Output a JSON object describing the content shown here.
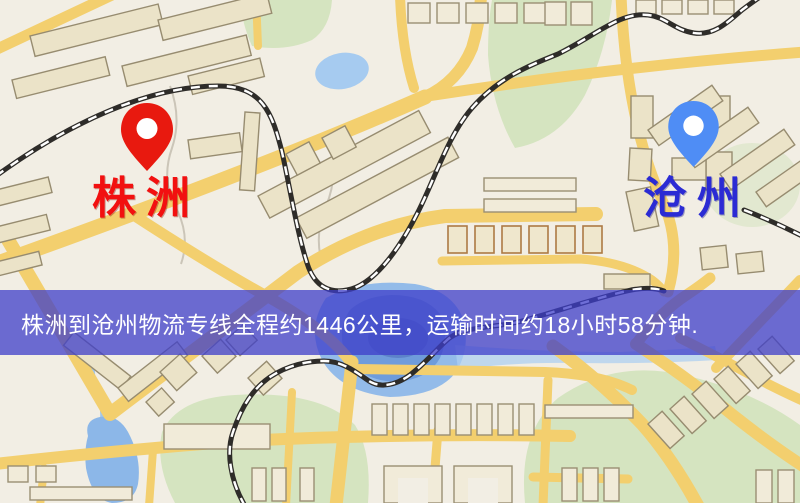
{
  "map": {
    "origin": {
      "name": "株洲",
      "pin_color": "#e8190f",
      "label_color": "#f21010"
    },
    "destination": {
      "name": "沧州",
      "pin_color": "#4f8df5",
      "label_color": "#2b2bd4"
    }
  },
  "banner": {
    "text": "株洲到沧州物流专线全程约1446公里，运输时间约18小时58分钟.",
    "distance": "约1446公里",
    "duration": "约18小时58分钟",
    "bg_color": "rgba(62,62,202,0.75)",
    "text_color": "#ffffff"
  },
  "colors": {
    "map_bg": "#f2eee4",
    "road": "#f3cf6e",
    "park": "#d5e4c0",
    "water": "#93bbe9",
    "building": "#ebe3c8",
    "railway": "#2e2c29"
  }
}
